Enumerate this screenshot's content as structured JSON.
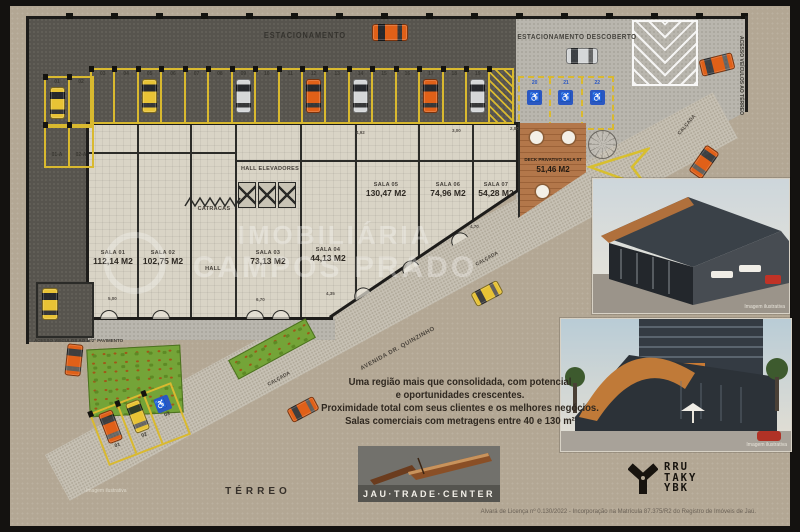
{
  "meta": {
    "floor_label": "TÉRREO",
    "license_text": "Alvará de Licença nº 0.130/2022 - Incorporação na Matrícula 87.375/R2 do Registro de Imóveis de Jaú."
  },
  "watermark": {
    "line1": "IMOBILIÁRIA",
    "line2": "CAMPOS PRADO"
  },
  "parking": {
    "covered_label": "ESTACIONAMENTO",
    "uncovered_label": "ESTACIONAMENTO DESCOBERTO",
    "row_spots": [
      "03",
      "04",
      "05",
      "06",
      "07",
      "08",
      "09",
      "10",
      "11",
      "12",
      "13",
      "14",
      "15",
      "16",
      "17",
      "18",
      "19"
    ],
    "corner_spots": [
      "01",
      "02"
    ],
    "corner_spots_b": [
      "01-A",
      "02-A"
    ],
    "accessible_spots": [
      "20",
      "21",
      "22"
    ],
    "angled_spots": [
      "01",
      "02",
      "03"
    ],
    "cars_in_spots": {
      "05": "yellow",
      "09": "silver",
      "12": "orange",
      "14": "silver",
      "17": "orange",
      "19": "silver"
    },
    "ramp_label": "ACESSO VEÍCULOS AO 1º/2º PAVIMENTO",
    "side_access_label": "ACESSO VEÍCULOS AO TÉRREO"
  },
  "building": {
    "hall_elevadores": "HALL ELEVADORES",
    "catracas": "CATRACAS",
    "hall": "HALL",
    "rooms": [
      {
        "name": "SALA 01",
        "area": "112,14 M2"
      },
      {
        "name": "SALA 02",
        "area": "102,75 M2"
      },
      {
        "name": "SALA 03",
        "area": "73,13 M2"
      },
      {
        "name": "SALA 04",
        "area": "44,13 M2"
      },
      {
        "name": "SALA 05",
        "area": "130,47 M2"
      },
      {
        "name": "SALA 06",
        "area": "74,96 M2"
      },
      {
        "name": "SALA 07",
        "area": "54,28 M2"
      }
    ],
    "deck_name": "DECK PRIVATIVO SALA 07",
    "deck_area": "51,46 M2",
    "dimensions": [
      "5,00",
      "4,92",
      "3,00",
      "2,80",
      "6,70",
      "4,35",
      "4,70"
    ]
  },
  "streets": {
    "avenue": "AVENIDA DR. QUINZINHO",
    "sidewalk": "CALÇADA"
  },
  "marketing": {
    "line1": "Uma região mais que consolidada, com potencial",
    "line2": "e oportunidades crescentes.",
    "line3": "Proximidade total com seus clientes e os melhores negócios.",
    "line4": "Salas comerciais com metragens entre 40 e 130 m²"
  },
  "logos": {
    "jau": "JAU·TRADE·CENTER",
    "studio": [
      "RRU",
      "TAKY",
      "YBK"
    ]
  },
  "captions": {
    "illustrative": "Imagem ilustrativa"
  },
  "colors": {
    "background": "#b3a794",
    "frame": "#141210",
    "asphalt": "#57544e",
    "concrete": "#b9b6ae",
    "sidewalk": "#c7c1b4",
    "floor": "#d9d4c6",
    "wall": "#2b2b28",
    "parking_yellow": "#d9b92f",
    "accessible_blue": "#2a57c2",
    "deck_wood": "#b3774a",
    "garden_green": "#74a438",
    "car_palette": {
      "yellow": "#e8c335",
      "silver": "#d5d7d8",
      "orange": "#e06018"
    }
  }
}
